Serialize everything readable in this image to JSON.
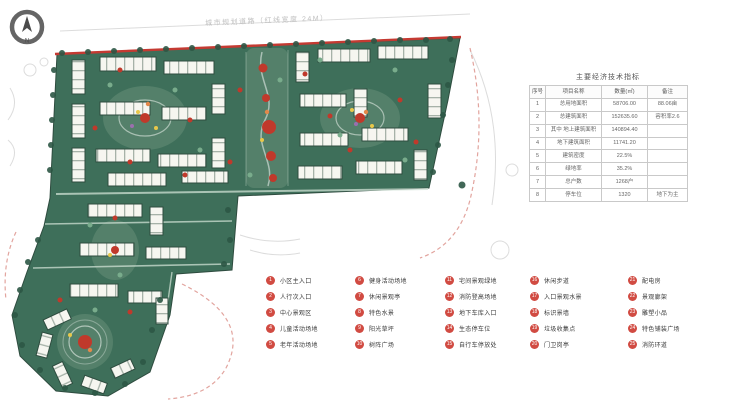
{
  "plan": {
    "top_note": "城市规划道路（红线宽度 24M）",
    "colors": {
      "ground": "#3e6f5a",
      "ground_light": "#54806a",
      "building": "#f6f6f0",
      "building_outline": "#2e4c3f",
      "node_red": "#c0392b",
      "boundary_red": "#c43a32",
      "tree_dark": "#2d5745",
      "tree_light": "#79ac8c",
      "legend_marker_red": "#d14b42",
      "sketch_gray": "#dcdcdc",
      "faint_red_dash": "#e2a49e"
    }
  },
  "compass": {
    "label": "N"
  },
  "table": {
    "title": "主要经济技术指标",
    "headers": [
      "序号",
      "项目名称",
      "数量(㎡)",
      "备注"
    ],
    "rows": [
      [
        "1",
        "总用地面积",
        "58706.00",
        "88.06亩"
      ],
      [
        "2",
        "总建筑面积",
        "152635.60",
        "容积率2.6"
      ],
      [
        "3",
        "其中 地上建筑面积",
        "140894.40",
        ""
      ],
      [
        "4",
        "地下建筑面积",
        "11741.20",
        ""
      ],
      [
        "5",
        "建筑密度",
        "22.5%",
        ""
      ],
      [
        "6",
        "绿地率",
        "35.2%",
        ""
      ],
      [
        "7",
        "总户数",
        "1268户",
        ""
      ],
      [
        "8",
        "停车位",
        "1320",
        "地下为主"
      ]
    ]
  },
  "legend": {
    "columns": [
      {
        "items": [
          {
            "num": "1",
            "label": "小区主入口"
          },
          {
            "num": "2",
            "label": "人行次入口"
          },
          {
            "num": "3",
            "label": "中心景观区"
          },
          {
            "num": "4",
            "label": "儿童活动场地"
          },
          {
            "num": "5",
            "label": "老年活动场地"
          }
        ]
      },
      {
        "items": [
          {
            "num": "6",
            "label": "健身活动场地"
          },
          {
            "num": "7",
            "label": "休闲景观亭"
          },
          {
            "num": "8",
            "label": "特色水景"
          },
          {
            "num": "9",
            "label": "阳光草坪"
          },
          {
            "num": "10",
            "label": "树阵广场"
          }
        ]
      },
      {
        "items": [
          {
            "num": "11",
            "label": "宅间景观绿地"
          },
          {
            "num": "12",
            "label": "消防登高场地"
          },
          {
            "num": "13",
            "label": "地下车库入口"
          },
          {
            "num": "14",
            "label": "生态停车位"
          },
          {
            "num": "15",
            "label": "自行车停放处"
          }
        ]
      },
      {
        "items": [
          {
            "num": "16",
            "label": "休闲步道"
          },
          {
            "num": "17",
            "label": "入口景观水景"
          },
          {
            "num": "18",
            "label": "标识景墙"
          },
          {
            "num": "19",
            "label": "垃圾收集点"
          },
          {
            "num": "20",
            "label": "门卫岗亭"
          }
        ]
      },
      {
        "items": [
          {
            "num": "21",
            "label": "配电房"
          },
          {
            "num": "22",
            "label": "景观廊架"
          },
          {
            "num": "23",
            "label": "雕塑小品"
          },
          {
            "num": "24",
            "label": "特色铺装广场"
          },
          {
            "num": "25",
            "label": "消防环道"
          }
        ]
      }
    ]
  }
}
